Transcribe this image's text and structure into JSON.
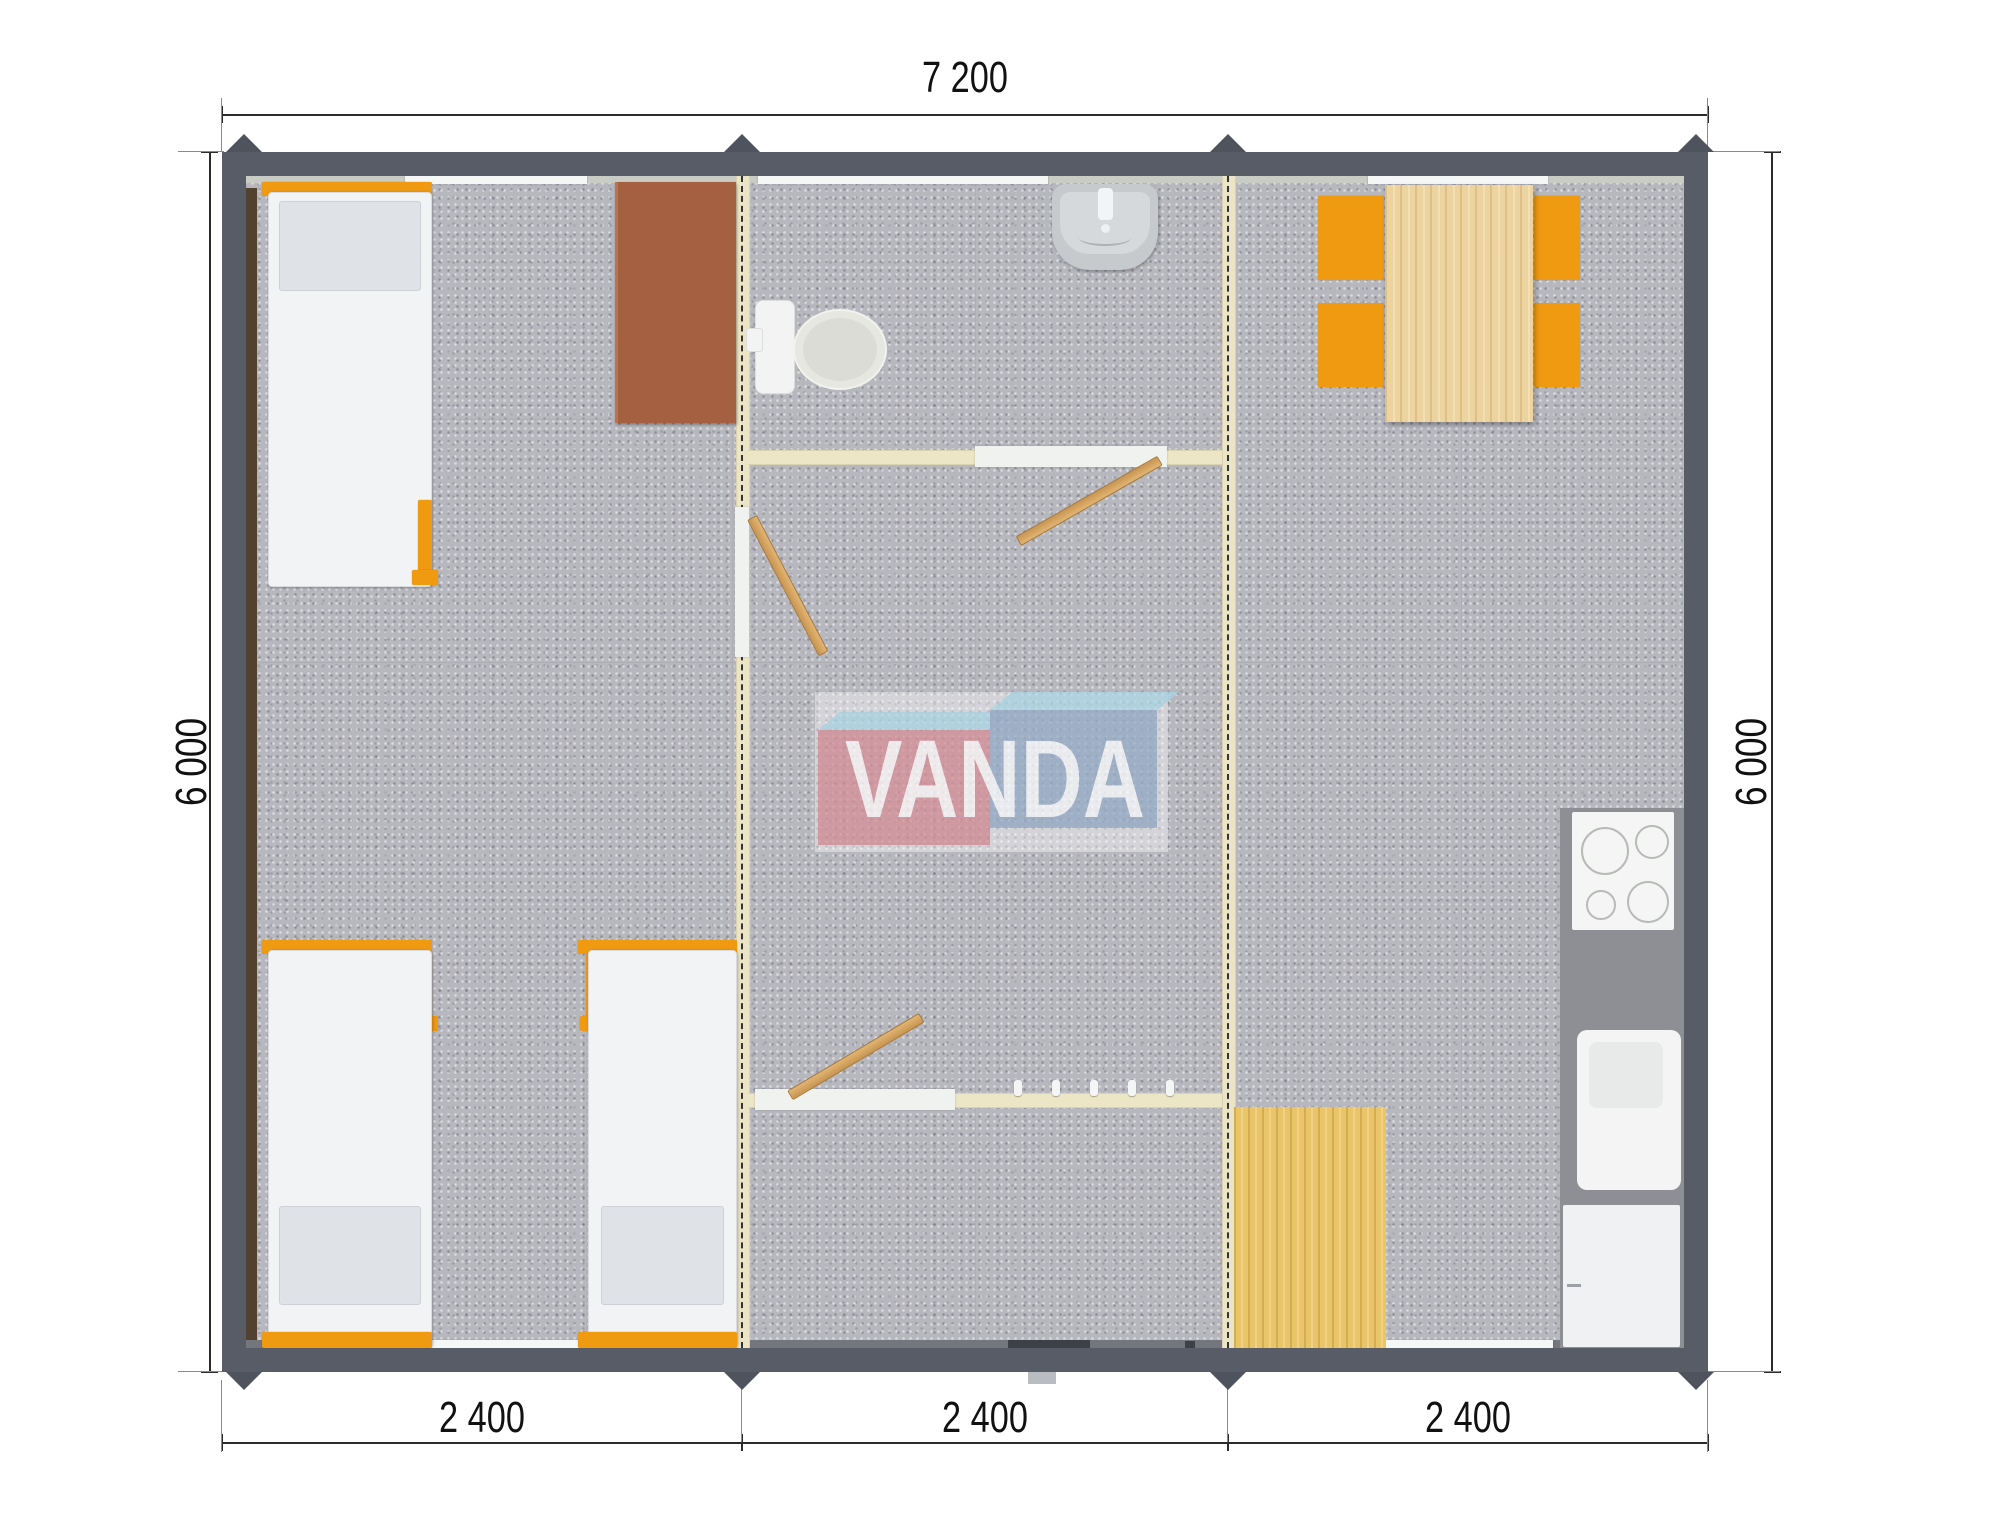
{
  "plan": {
    "dims": {
      "top": "7 200",
      "left": "6 000",
      "right": "6 000",
      "bottom": [
        "2 400",
        "2 400",
        "2 400"
      ]
    },
    "logo": {
      "text": "VANDA"
    },
    "colors": {
      "wall": "#575c66",
      "floor": "#b7b7be",
      "divider": "#ece5c5",
      "accent_orange": "#ef9a10",
      "wood": "#e9c468",
      "wood_light": "#ecd3a0",
      "desk_brown": "#a55f41",
      "counter_gray": "#8e8e95",
      "fixture_white": "#f2f3f2",
      "logo_red": "#d4868f",
      "logo_blue": "#8fa7c4",
      "logo_top_blue": "#a9d6e6"
    },
    "furniture_icons": [
      "single-bed",
      "single-bed",
      "single-bed",
      "wardrobe-desk",
      "toilet",
      "wash-basin",
      "interior-door",
      "interior-door",
      "interior-door",
      "coat-hooks",
      "dining-table",
      "chair",
      "chair",
      "chair",
      "chair",
      "cooktop",
      "kitchen-sink",
      "fridge-cabinet",
      "wood-floor-mat"
    ]
  }
}
